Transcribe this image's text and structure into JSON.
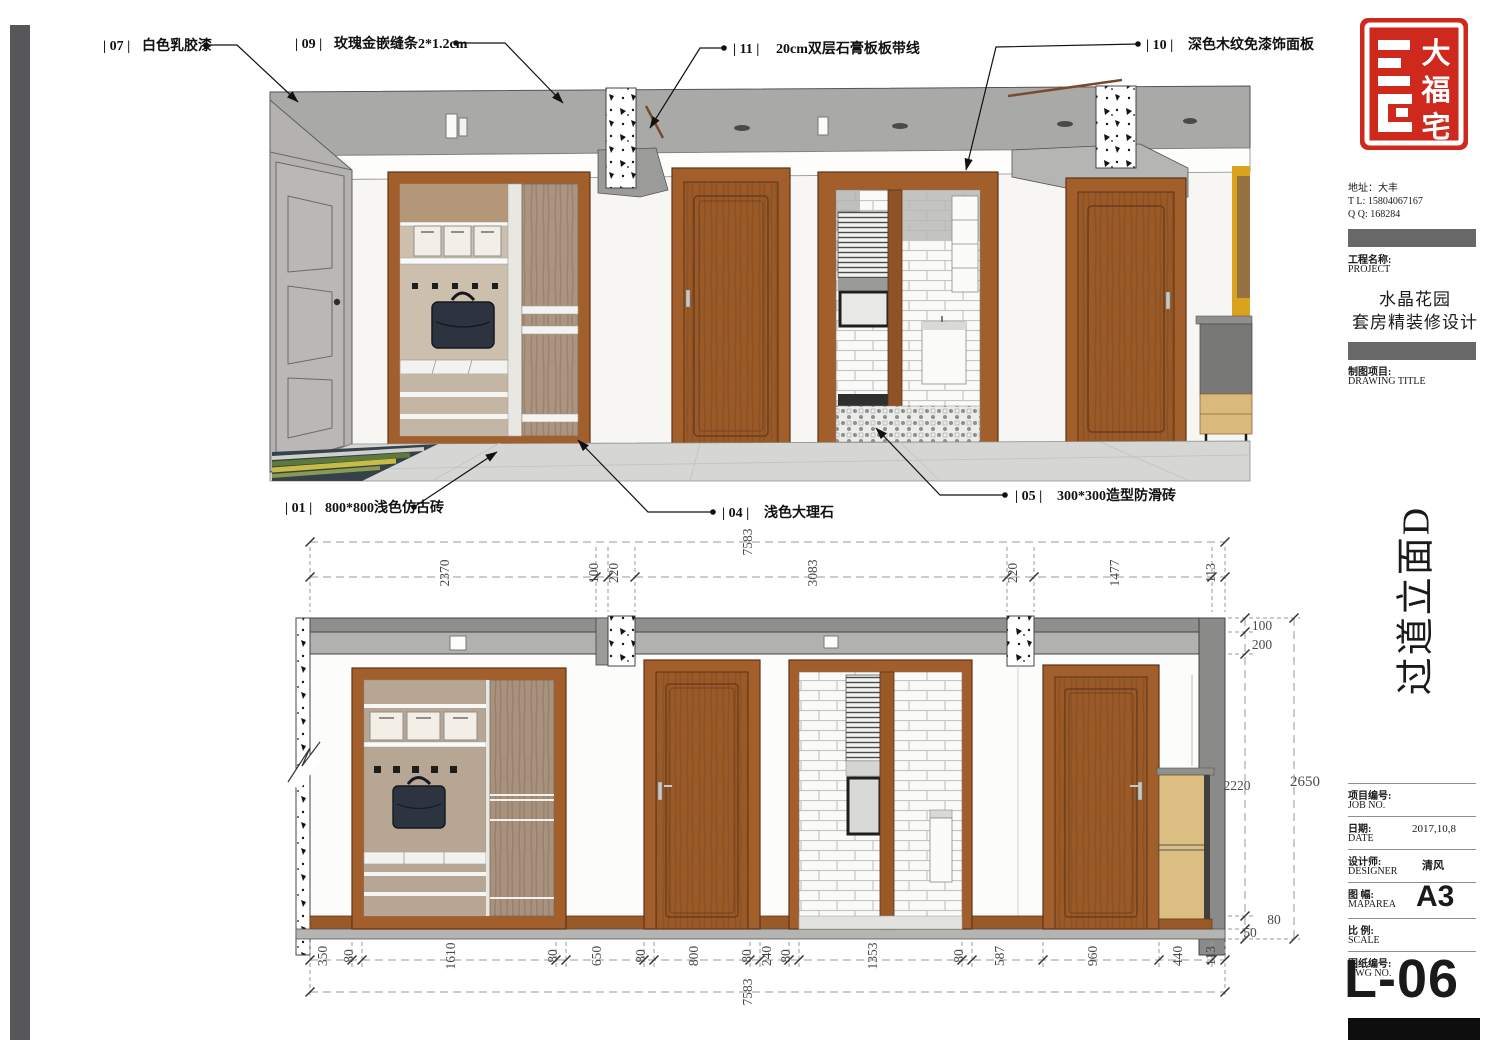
{
  "callouts": {
    "c07": {
      "tag": "| 07 |",
      "label": "白色乳胶漆"
    },
    "c09": {
      "tag": "| 09 |",
      "label": "玫瑰金嵌缝条2*1.2cm"
    },
    "c11": {
      "tag": "| 11 |",
      "label": "20cm双层石膏板板带线"
    },
    "c10": {
      "tag": "| 10 |",
      "label": "深色木纹免漆饰面板"
    },
    "c01": {
      "tag": "| 01 |",
      "label": "800*800浅色仿古砖"
    },
    "c04": {
      "tag": "| 04 |",
      "label": "浅色大理石"
    },
    "c05": {
      "tag": "| 05 |",
      "label": "300*300造型防滑砖"
    }
  },
  "dims": {
    "total_width": "7583",
    "total_height": "2650",
    "top": [
      "2370",
      "100",
      "220",
      "3083",
      "220",
      "1477",
      "113"
    ],
    "bottom": [
      "350",
      "80",
      "1610",
      "80",
      "650",
      "80",
      "800",
      "80",
      "240",
      "80",
      "1353",
      "80",
      "587",
      "960",
      "440",
      "113"
    ],
    "right": [
      "100",
      "200",
      "2220",
      "80",
      "50"
    ]
  },
  "title_block": {
    "logo_chars": [
      "大",
      "福",
      "宅"
    ],
    "address": "地址：大丰",
    "tel": "T  L:   15804067167",
    "qq": "Q  Q:   168284",
    "project_label_cn": "工程名称:",
    "project_label_en": "PROJECT",
    "project_name_1": "水晶花园",
    "project_name_2": "套房精装修设计",
    "drawing_label_cn": "制图项目:",
    "drawing_label_en": "DRAWING TITLE",
    "drawing_title": "过道立面D",
    "rows": [
      {
        "cn": "项目编号:",
        "en": "JOB NO.",
        "value": ""
      },
      {
        "cn": "日期:",
        "en": "DATE",
        "value": "2017,10,8"
      },
      {
        "cn": "设计师:",
        "en": "DESIGNER",
        "value": "清风"
      },
      {
        "cn": "图 幅:",
        "en": "MAPAREA",
        "value": "A3"
      },
      {
        "cn": "比 例:",
        "en": "SCALE",
        "value": ""
      },
      {
        "cn": "图纸编号:",
        "en": "DWG NO.",
        "value": ""
      }
    ],
    "sheet_no": "L-06"
  }
}
